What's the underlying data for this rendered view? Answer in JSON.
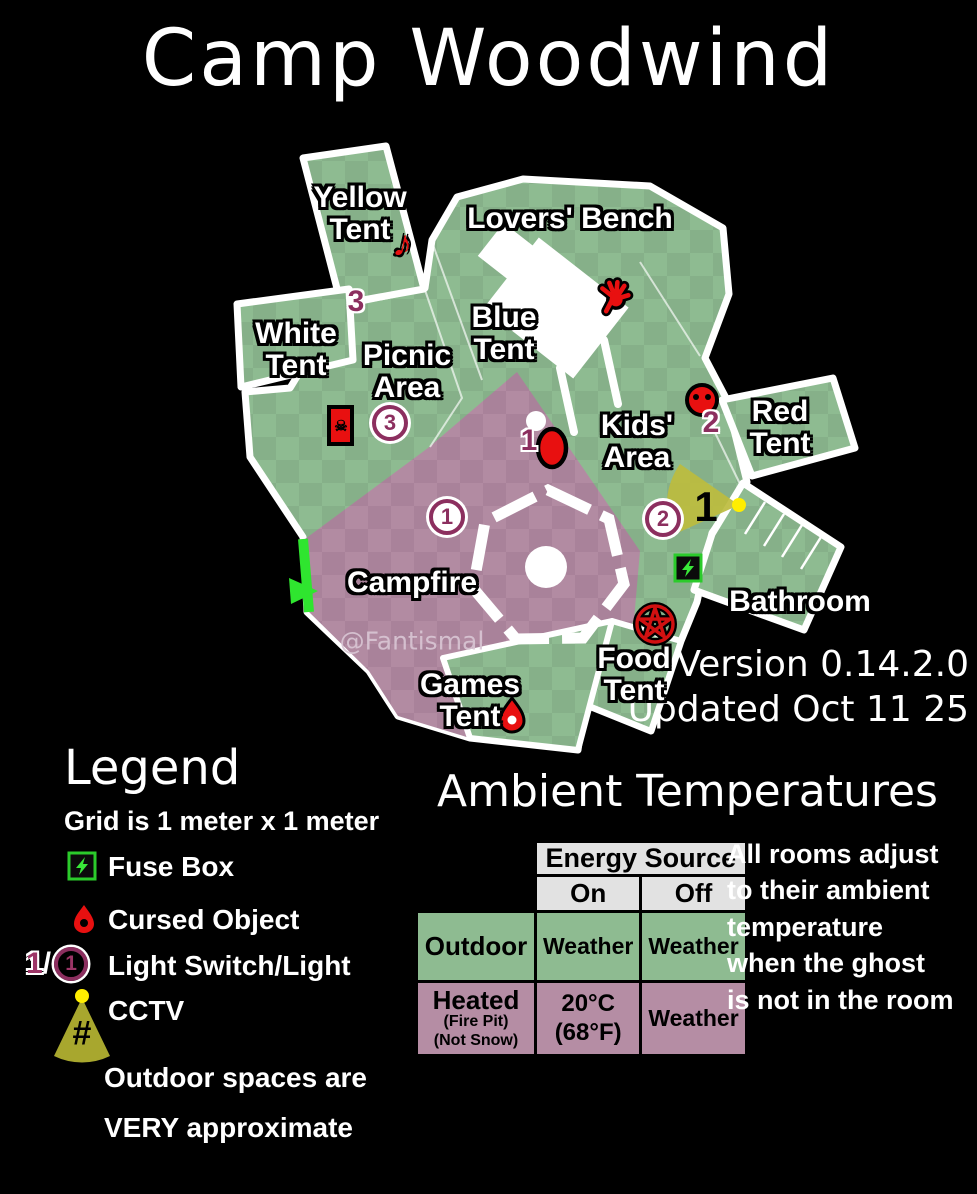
{
  "title": "Camp Woodwind",
  "watermark": "@Fantismal",
  "version": {
    "line1": "Version 0.14.2.0",
    "line2": "Updated Oct 11 25"
  },
  "map": {
    "labels": {
      "yellow_tent": "Yellow\nTent",
      "lovers_bench": "Lovers' Bench",
      "white_tent": "White\nTent",
      "picnic_area": "Picnic\nArea",
      "blue_tent": "Blue\nTent",
      "kids_area": "Kids'\nArea",
      "red_tent": "Red\nTent",
      "campfire": "Campfire",
      "bathroom": "Bathroom",
      "food_tent": "Food\nTent",
      "games_tent": "Games\nTent"
    },
    "markers": {
      "switch_1": "1",
      "switch_2": "2",
      "switch_3": "3",
      "light_1": "1",
      "light_2": "2",
      "light_3": "3",
      "cctv_1": "1",
      "cctv_hash": "#",
      "music_note": "♪",
      "skull": "☠"
    }
  },
  "legend": {
    "heading": "Legend",
    "grid_note": "Grid is 1 meter x 1 meter",
    "fuse_label": "Fuse Box",
    "cursed_label": "Cursed Object",
    "light_prefix_switch": "1",
    "light_prefix_sep": "/",
    "light_prefix_num": "1",
    "light_label": "Light Switch/Light",
    "cctv_label": "CCTV",
    "cctv_hash": "#",
    "note_line1": "Outdoor spaces are",
    "note_line2": "VERY approximate"
  },
  "ambient": {
    "heading": "Ambient Temperatures",
    "table": {
      "energy_header": "Energy Source",
      "on": "On",
      "off": "Off",
      "outdoor": {
        "name": "Outdoor",
        "on": "Weather",
        "off": "Weather"
      },
      "heated": {
        "name": "Heated",
        "sub1": "(Fire Pit)",
        "sub2": "(Not Snow)",
        "on": "20°C\n(68°F)",
        "off": "Weather"
      }
    },
    "note": "All rooms adjust\nto their ambient\ntemperature\nwhen the ghost\nis not in the room"
  },
  "colors": {
    "background": "#000000",
    "map_green": "#8EBB91",
    "map_green_dark": "#86B089",
    "map_purple": "#B28BA2",
    "map_purple_dark": "#A9829A",
    "cursed_red": "#E81010",
    "switch_purple": "#8C2F5F",
    "fuse_green": "#39E839",
    "entrance_green": "#2FE52F",
    "cctv_yellow": "#BDBC3E",
    "cctv_dot": "#FFEE00",
    "table_gray": "#E2E2E2",
    "table_green": "#8EBB91",
    "table_purple": "#B58DA4"
  }
}
